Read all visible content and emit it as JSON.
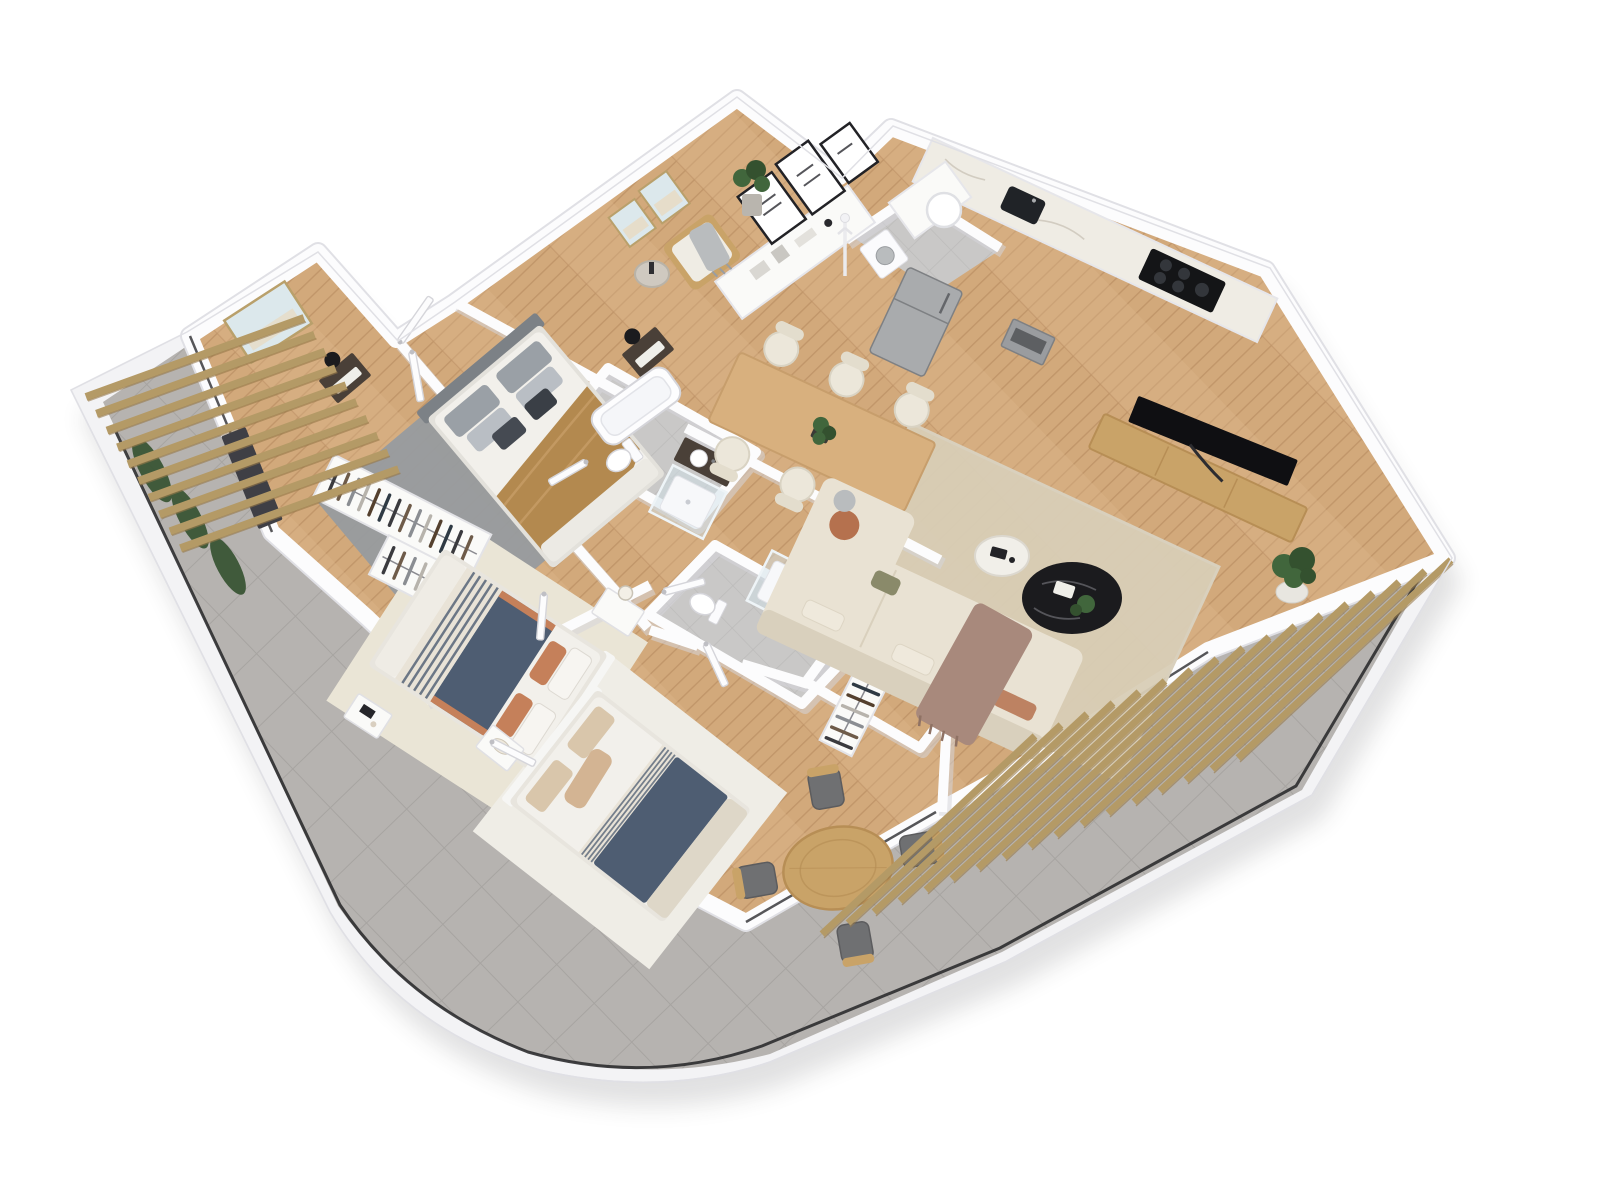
{
  "scene": {
    "type": "3d-floor-plan-render",
    "view": "isometric top-down, plan rotated ~40 degrees on white background",
    "visible_text": "",
    "apartment": "3-bedroom, 2-bathroom apartment with wrap-around tiled terrace, curved bottom-left corner, wooden pergolas on left and right"
  },
  "palette": {
    "page-bg": "#ffffff",
    "band": "#f3f3f5",
    "band-edge": "#e0e0e5",
    "tile": "#b6b3b0",
    "tile-line": "#a7a4a1",
    "bath-tile": "#c9c8c7",
    "bath-tile-line": "#bcbbba",
    "wall": "#fcfcfd",
    "wall-shadow": "#d6d6db",
    "wood": "#d2a97b",
    "wood-line": "#c1966a",
    "wood-alt": "#dcb68c",
    "rug-gray": "#979b9f",
    "rug-beige": "#d8cdb6",
    "rug-cream": "#eae5d6",
    "rug-white": "#efede6",
    "bed-white": "#f2f0eb",
    "navy": "#4e5d72",
    "ochre": "#b3894f",
    "terracotta": "#c5805a",
    "stripe-light": "#e9e3d7",
    "headboard-gray": "#7c8186",
    "pillow-gray": "#9aa0a6",
    "pillow-check": "#454a52",
    "pillow-beige": "#d9c6ab",
    "pillow-tan": "#d3b493",
    "foot-cream": "#ded7c8",
    "sofa": "#e9e2d3",
    "sofa-edge": "#d9d0bd",
    "throw-brown": "#a8897c",
    "pillow-rust": "#b5714e",
    "pillow-olive": "#8a8a6a",
    "furn-wood": "#c9a368",
    "furn-wood-edge": "#b78e55",
    "dark-wood": "#4a4038",
    "black": "#1b1b1e",
    "steel": "#a9abad",
    "steel-dark": "#7e8083",
    "white-furn": "#fafaf8",
    "marble": "#efece4",
    "glass": "#cfe0e8",
    "green": "#41663c",
    "green-dark": "#34512f",
    "pot": "#e8e6e0",
    "chair-cream": "#ece7da",
    "chair-cream-edge": "#d9d3c3",
    "chair-gray": "#6f7072",
    "railing": "#2c2c2f",
    "pergola": "#b49a66",
    "pergola-dark": "#97794a",
    "door-edge": "#d5d5da",
    "frame-black": "#222226",
    "art-blue": "#dce8ec",
    "art-sand": "#e6ddca",
    "gold": "#b9a06b"
  },
  "counts": {
    "bedrooms": 3,
    "bathrooms": 2,
    "dining_chairs": 6,
    "terrace_chairs": 4,
    "pergola_left_slats": 10,
    "pergola_right_slats": 17,
    "gallery_frames": 3,
    "entry_wall_frames": 2,
    "wardrobe_racks": 4,
    "rack_items": [
      14,
      12,
      10,
      7
    ]
  },
  "wardrobe_colors": [
    "#3a3a3e",
    "#6e5b49",
    "#8a8d92",
    "#b7b3ac",
    "#54402e",
    "#2f3a44"
  ],
  "rooms": [
    {
      "id": "master-bedroom",
      "area": "upper-left",
      "floor": "wood",
      "items": [
        "double-bed-white-duvet-ochre-throw",
        "gray-area-rug",
        "dark-nightstand-left",
        "dark-nightstand-right",
        "black-table-lamps",
        "seascape-wall-art",
        "dark-wardrobe",
        "gray-checked-pillows"
      ]
    },
    {
      "id": "walk-in-closet",
      "area": "below-master",
      "floor": "wood",
      "items": [
        "open-wardrobe-rack-a",
        "open-wardrobe-rack-b",
        "hanging-clothes"
      ]
    },
    {
      "id": "bedroom-2",
      "area": "lower-left",
      "floor": "wood",
      "items": [
        "double-bed-navy-duvet-striped-blanket",
        "terracotta-pillows",
        "cream-rug",
        "white-nightstands",
        "glass-globe-lamp",
        "coffee-tray-table"
      ]
    },
    {
      "id": "bedroom-3",
      "area": "bottom-center",
      "floor": "wood",
      "items": [
        "double-bed-navy-blanket",
        "beige-tan-pillows",
        "white-rug",
        "white-nightstand-with-tray",
        "open-closet-with-clothes"
      ]
    },
    {
      "id": "hallway",
      "area": "center",
      "floor": "wood",
      "items": [
        "entry-door",
        "five-interior-doors"
      ]
    },
    {
      "id": "bathroom-1",
      "area": "center",
      "floor": "gray-tile",
      "items": [
        "bathtub",
        "walk-in-glass-shower",
        "toilet",
        "dark-wood-vanity-sink"
      ]
    },
    {
      "id": "bathroom-2",
      "area": "center-lower",
      "floor": "gray-tile",
      "items": [
        "walk-in-glass-shower",
        "toilet",
        "dark-wood-vanity-sink"
      ]
    },
    {
      "id": "kitchen",
      "area": "upper-right",
      "floor": "wood",
      "items": [
        "white-cabinet-run",
        "marble-countertop",
        "black-induction-cooktop",
        "black-sink",
        "steel-oven",
        "stainless-fridge",
        "washing-machine",
        "water-heater",
        "gray-laundry-nook"
      ]
    },
    {
      "id": "dining-area",
      "area": "center-right",
      "floor": "wood",
      "items": [
        "rectangular-wood-table",
        "six-cream-chairs",
        "plant-centerpiece"
      ]
    },
    {
      "id": "living-room",
      "area": "right",
      "floor": "wood",
      "items": [
        "l-shaped-beige-sofa",
        "brown-throw",
        "rust-pillow",
        "black-round-coffee-table",
        "white-round-side-table",
        "beige-rug",
        "wood-tv-console",
        "flat-screen-tv",
        "potted-ficus-plant",
        "wooden-armchair-white-cushions",
        "gray-throw",
        "round-glass-side-table",
        "white-console-sideboard",
        "gallery-wall-frames",
        "monstera-plant",
        "coat-rack",
        "seascape-frames"
      ]
    },
    {
      "id": "terrace",
      "area": "wrap-around left-bottom-right, curved corner",
      "floor": "gray-tile",
      "items": [
        "round-wood-table",
        "four-gray-cushion-chairs",
        "wood-pergola-left",
        "wood-pergola-right",
        "black-perimeter-railing",
        "planter-greenery",
        "dark-sliding-door-frames"
      ]
    }
  ]
}
